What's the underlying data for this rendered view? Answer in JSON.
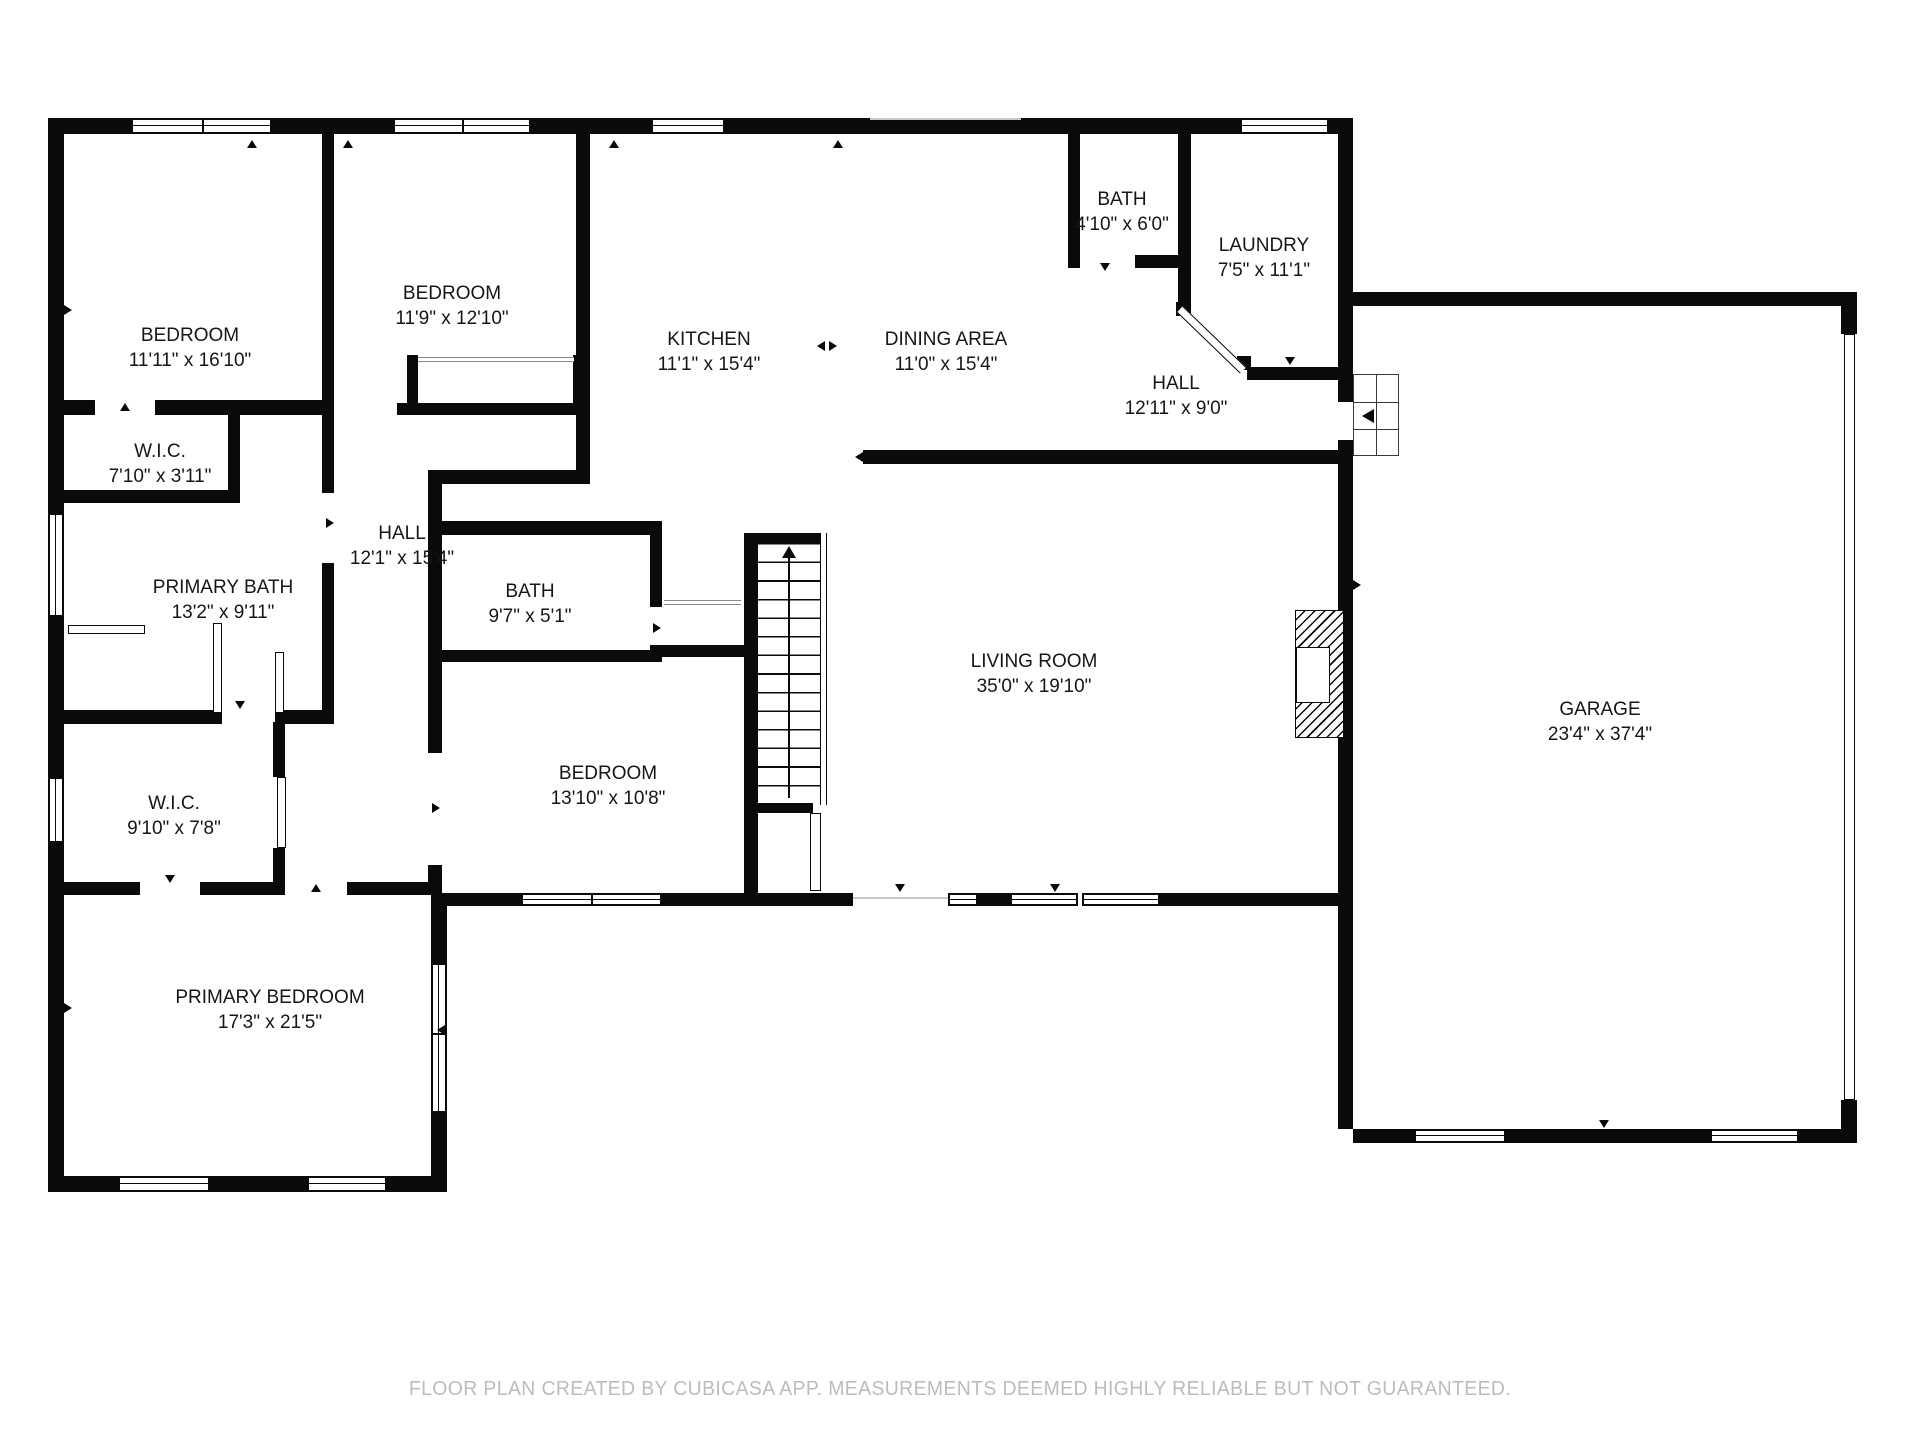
{
  "plan": {
    "wall_color": "#0a0a0a",
    "text_color": "#161616",
    "stairs": {
      "direction": "up"
    },
    "footer": {
      "text": "FLOOR PLAN CREATED BY CUBICASA APP. MEASUREMENTS DEEMED HIGHLY RELIABLE BUT NOT GUARANTEED.",
      "color": "#bcbcbc"
    },
    "rooms": [
      {
        "key": "bedroom-1",
        "name": "BEDROOM",
        "dims": "11'11\" x 16'10\"",
        "x": 190,
        "y": 348
      },
      {
        "key": "bedroom-2",
        "name": "BEDROOM",
        "dims": "11'9\" x 12'10\"",
        "x": 452,
        "y": 306
      },
      {
        "key": "kitchen",
        "name": "KITCHEN",
        "dims": "11'1\" x 15'4\"",
        "x": 709,
        "y": 352
      },
      {
        "key": "dining-area",
        "name": "DINING AREA",
        "dims": "11'0\" x 15'4\"",
        "x": 946,
        "y": 352
      },
      {
        "key": "bath-upper",
        "name": "BATH",
        "dims": "4'10\" x 6'0\"",
        "x": 1122,
        "y": 212
      },
      {
        "key": "laundry",
        "name": "LAUNDRY",
        "dims": "7'5\" x 11'1\"",
        "x": 1264,
        "y": 258
      },
      {
        "key": "hall-entry",
        "name": "HALL",
        "dims": "12'11\" x 9'0\"",
        "x": 1176,
        "y": 396
      },
      {
        "key": "wic-small",
        "name": "W.I.C.",
        "dims": "7'10\" x 3'11\"",
        "x": 160,
        "y": 464
      },
      {
        "key": "primary-bath",
        "name": "PRIMARY BATH",
        "dims": "13'2\" x 9'11\"",
        "x": 223,
        "y": 600
      },
      {
        "key": "hall-bedrooms",
        "name": "HALL",
        "dims": "12'1\" x 15'4\"",
        "x": 402,
        "y": 546
      },
      {
        "key": "bath-middle",
        "name": "BATH",
        "dims": "9'7\" x 5'1\"",
        "x": 530,
        "y": 604
      },
      {
        "key": "bedroom-3",
        "name": "BEDROOM",
        "dims": "13'10\" x 10'8\"",
        "x": 608,
        "y": 786
      },
      {
        "key": "living-room",
        "name": "LIVING ROOM",
        "dims": "35'0\" x 19'10\"",
        "x": 1034,
        "y": 674
      },
      {
        "key": "wic-primary",
        "name": "W.I.C.",
        "dims": "9'10\" x 7'8\"",
        "x": 174,
        "y": 816
      },
      {
        "key": "primary-bedroom",
        "name": "PRIMARY BEDROOM",
        "dims": "17'3\" x 21'5\"",
        "x": 270,
        "y": 1010
      },
      {
        "key": "garage",
        "name": "GARAGE",
        "dims": "23'4\" x 37'4\"",
        "x": 1600,
        "y": 722
      }
    ]
  }
}
